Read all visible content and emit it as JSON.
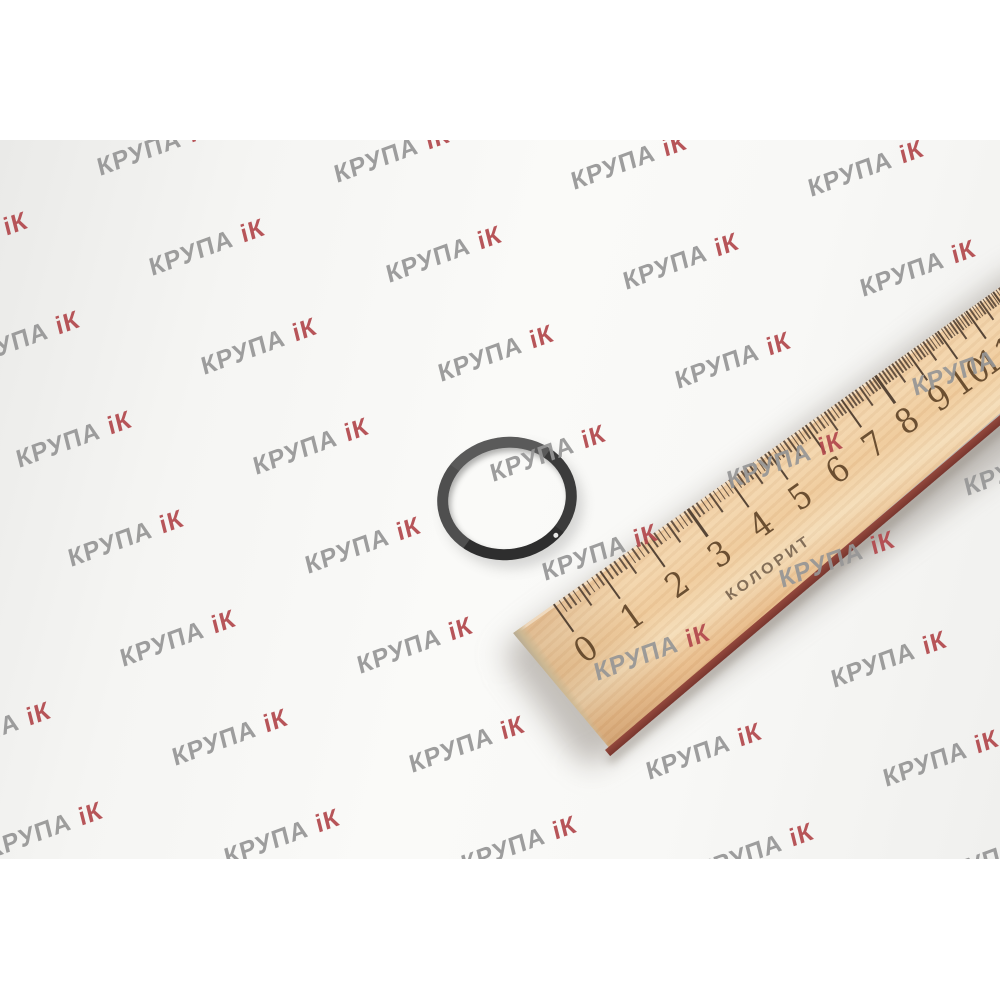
{
  "watermark": {
    "text_gray": "КРУПА",
    "text_red": "іК",
    "color_gray": "#969696",
    "color_red": "#b2484c"
  },
  "ruler": {
    "brand": "КОЛОРИТ",
    "numbers": [
      "0",
      "1",
      "2",
      "3",
      "4",
      "5",
      "6",
      "7",
      "8",
      "9",
      "10",
      "11"
    ],
    "wood_color": "#eec89c",
    "edge_color": "#8e4a3e",
    "tick_color": "#46362a",
    "number_color": "#553a20"
  },
  "oring": {
    "color": "#3b3b3b"
  }
}
